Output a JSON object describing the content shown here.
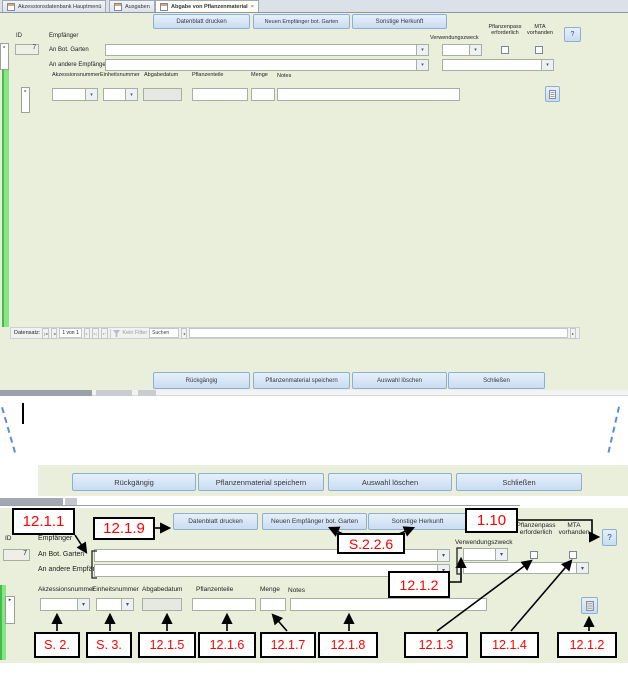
{
  "tabs": {
    "items": [
      {
        "label": "Akzessionsdatenbank Hauptmenü"
      },
      {
        "label": "Ausgaben"
      },
      {
        "label": "Abgabe von Pflanzenmaterial"
      }
    ],
    "close": "×"
  },
  "form": {
    "toolbar": [
      "Datenblatt drucken",
      "Neuen Empfänger bot. Garten",
      "Sonstige Herkunft"
    ],
    "fields": {
      "id_label": "ID",
      "id_value": "7",
      "empfaenger": "Empfänger",
      "an_bot_garten": "An Bot. Garten",
      "an_andere_empfaenger": "An andere Empfänger",
      "verwendungszweck": "Verwendungszweck",
      "pflanzenpass": "Pflanzenpass erforderlich",
      "mta": "MTA vorhanden",
      "help": "?"
    },
    "columns": [
      "Akzessionsnummer",
      "Einheitsnummer",
      "Abgabedatum",
      "Pflanzenteile",
      "Menge",
      "Notes"
    ],
    "footer": [
      "Rückgängig",
      "Pflanzenmaterial speichern",
      "Auswahl löschen",
      "Schließen"
    ],
    "navigator": {
      "label": "Datensatz:",
      "position": "1 von 1",
      "filter": "Kein Filter",
      "search": "Suchen"
    }
  },
  "icons": {
    "dropdown": "▾",
    "record_arrow": "▸",
    "nav_first": "|◂",
    "nav_prev": "◂",
    "nav_next": "▸",
    "nav_last": "▸|",
    "nav_new": "▸*"
  },
  "annotations": {
    "c_12_1_1": "12.1.1",
    "c_12_1_9": "12.1.9",
    "c_1_10": "1.10",
    "c_s_2_2_6": "S.2.2.6",
    "c_12_1_2_top": "12.1.2",
    "bottom_row": [
      "S. 2.",
      "S. 3.",
      "12.1.5",
      "12.1.6",
      "12.1.7",
      "12.1.8",
      "12.1.3",
      "12.1.4",
      "12.1.2"
    ]
  },
  "colors": {
    "form_bg": "#e9efdb",
    "button_face": "#d3e3f4",
    "button_border": "#8fafd2",
    "record_bar_green": "#86e686",
    "annotation_red": "#ff0000",
    "crop_mark_blue": "#5b8ed6"
  }
}
